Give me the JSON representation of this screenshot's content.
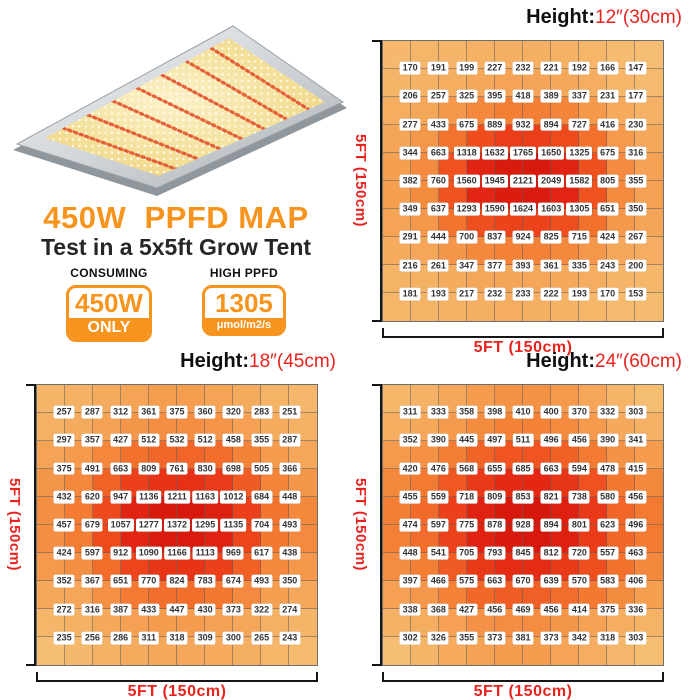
{
  "title": {
    "main": "450W  PPFD MAP",
    "sub": "Test in a 5x5ft Grow Tent"
  },
  "badges": [
    {
      "label": "CONSUMING",
      "value": "450W",
      "unit": "ONLY"
    },
    {
      "label": "HIGH PPFD",
      "value": "1305",
      "unit": "μmol/m2/s"
    }
  ],
  "colors": {
    "accent_orange": "#F7941D",
    "red_text": "#E8231D",
    "heatmap_ramp": [
      "#F5BE72",
      "#F5A052",
      "#F37B31",
      "#EF4E1E",
      "#E32613",
      "#D01208"
    ],
    "heatmap_ramp_stops": [
      0,
      0.2,
      0.4,
      0.6,
      0.8,
      1
    ],
    "heatmap_gamma": 0.72
  },
  "chart_data": [
    {
      "type": "heatmap",
      "title_prefix": "Height:",
      "title_value": "12″(30cm)",
      "x_label": "5FT (150cm)",
      "y_label": "5FT (150cm)",
      "values": [
        [
          170,
          191,
          199,
          227,
          232,
          221,
          192,
          166,
          147
        ],
        [
          206,
          257,
          325,
          395,
          418,
          389,
          337,
          231,
          177
        ],
        [
          277,
          433,
          675,
          889,
          932,
          894,
          727,
          416,
          230
        ],
        [
          344,
          663,
          1318,
          1632,
          1765,
          1650,
          1325,
          675,
          316
        ],
        [
          382,
          760,
          1560,
          1945,
          2121,
          2049,
          1582,
          805,
          355
        ],
        [
          349,
          637,
          1293,
          1590,
          1624,
          1603,
          1305,
          651,
          350
        ],
        [
          291,
          444,
          700,
          837,
          924,
          825,
          715,
          424,
          267
        ],
        [
          216,
          261,
          347,
          377,
          393,
          361,
          335,
          243,
          200
        ],
        [
          181,
          193,
          217,
          232,
          233,
          222,
          193,
          170,
          153
        ]
      ]
    },
    {
      "type": "heatmap",
      "title_prefix": "Height:",
      "title_value": "18″(45cm)",
      "x_label": "5FT (150cm)",
      "y_label": "5FT (150cm)",
      "values": [
        [
          257,
          287,
          312,
          361,
          375,
          360,
          320,
          283,
          251
        ],
        [
          297,
          357,
          427,
          512,
          532,
          512,
          458,
          355,
          287
        ],
        [
          375,
          491,
          663,
          809,
          761,
          830,
          698,
          505,
          366
        ],
        [
          432,
          620,
          947,
          1136,
          1211,
          1163,
          1012,
          684,
          448
        ],
        [
          457,
          679,
          1057,
          1277,
          1372,
          1295,
          1135,
          704,
          493
        ],
        [
          424,
          597,
          912,
          1090,
          1166,
          1113,
          969,
          617,
          438
        ],
        [
          352,
          367,
          651,
          770,
          824,
          783,
          674,
          493,
          350
        ],
        [
          272,
          316,
          387,
          433,
          447,
          430,
          373,
          322,
          274
        ],
        [
          235,
          256,
          286,
          311,
          318,
          309,
          300,
          265,
          243
        ]
      ]
    },
    {
      "type": "heatmap",
      "title_prefix": "Height:",
      "title_value": "24″(60cm)",
      "x_label": "5FT (150cm)",
      "y_label": "5FT (150cm)",
      "values": [
        [
          311,
          333,
          358,
          398,
          410,
          400,
          370,
          332,
          303
        ],
        [
          352,
          390,
          445,
          497,
          511,
          496,
          456,
          390,
          341
        ],
        [
          420,
          476,
          568,
          655,
          685,
          663,
          594,
          478,
          415
        ],
        [
          455,
          559,
          718,
          809,
          853,
          821,
          738,
          580,
          456
        ],
        [
          474,
          597,
          775,
          878,
          928,
          894,
          801,
          623,
          496
        ],
        [
          448,
          541,
          705,
          793,
          845,
          812,
          720,
          557,
          463
        ],
        [
          397,
          466,
          575,
          663,
          670,
          639,
          570,
          583,
          406
        ],
        [
          338,
          368,
          427,
          456,
          469,
          456,
          414,
          375,
          336
        ],
        [
          302,
          326,
          355,
          373,
          381,
          373,
          342,
          318,
          303
        ]
      ]
    }
  ]
}
